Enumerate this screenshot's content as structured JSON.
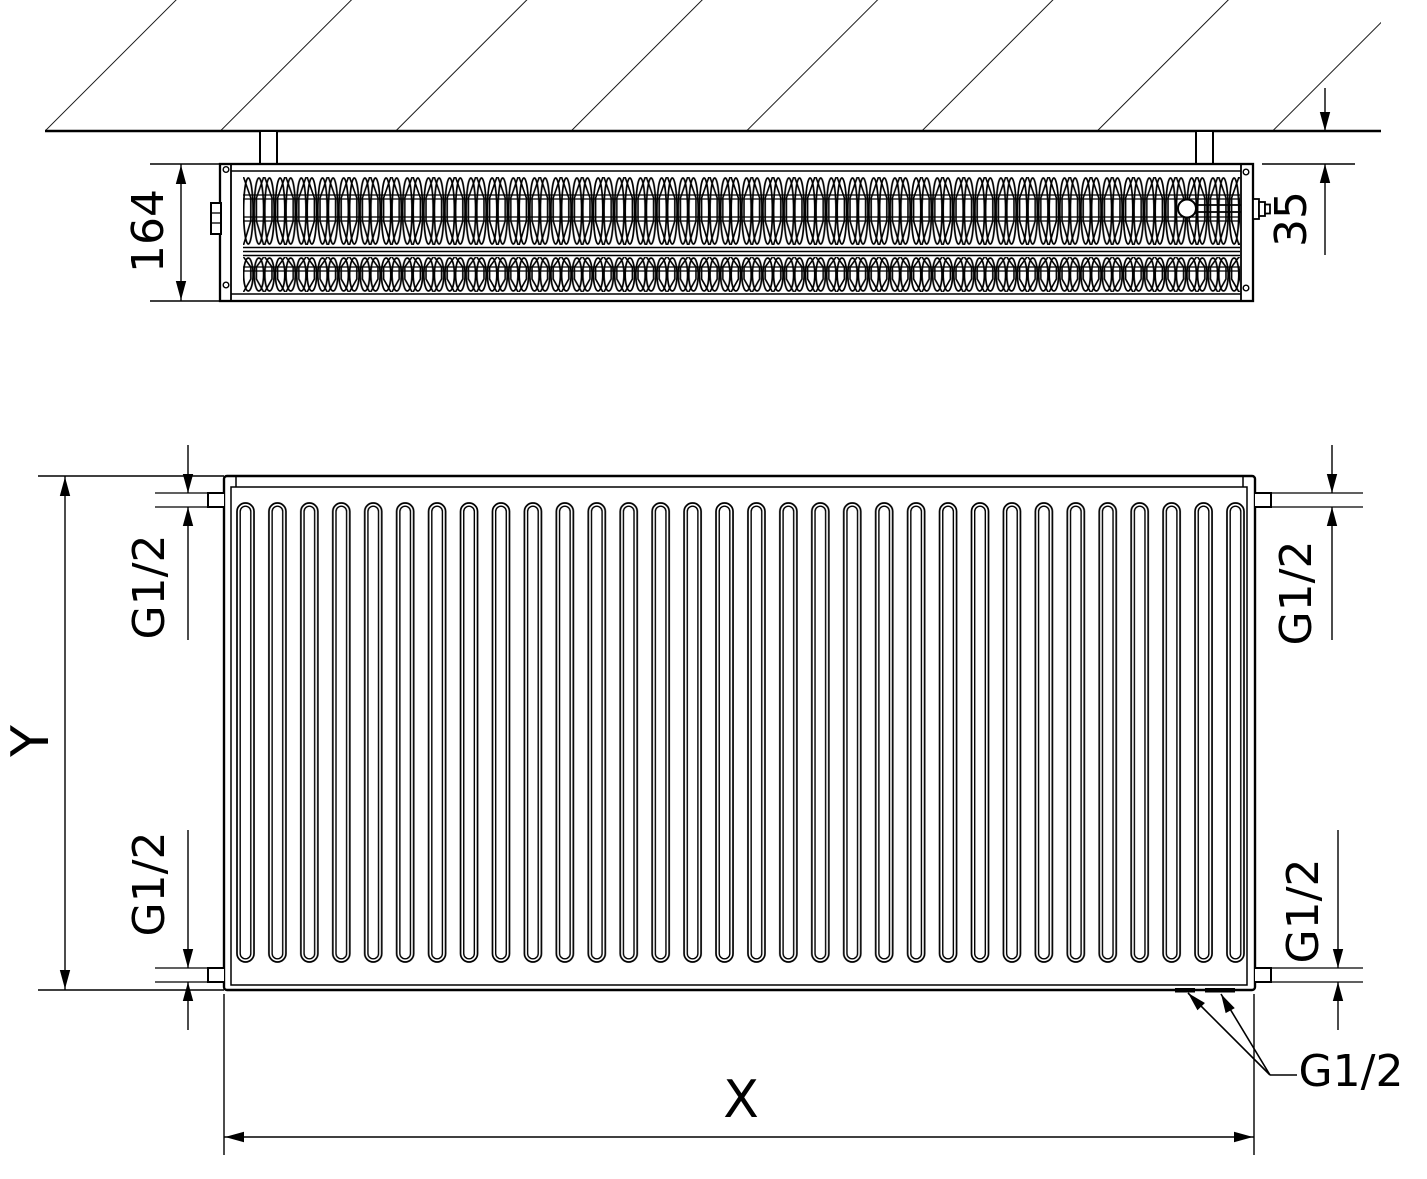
{
  "drawing": {
    "description": "Technical dimension drawing of a panel radiator: top cross-section view mounted at a hatched wall, and a front elevation view",
    "colors": {
      "line": "#000000",
      "background": "#ffffff",
      "text": "#000000"
    },
    "top_view": {
      "dimensions": {
        "depth": {
          "value": "164",
          "orientation": "rotated-90"
        },
        "wall_clearance": {
          "value": "35",
          "orientation": "rotated-90"
        }
      }
    },
    "front_view": {
      "dimensions": {
        "height": {
          "value": "Y",
          "orientation": "rotated-90"
        },
        "length": {
          "value": "X",
          "orientation": "horizontal"
        }
      },
      "connections": {
        "top_left": "G1/2",
        "bottom_left": "G1/2",
        "top_right": "G1/2",
        "bottom_right": "G1/2",
        "bottom_ports_callout": "G1/2"
      },
      "channel_count": 32
    }
  }
}
